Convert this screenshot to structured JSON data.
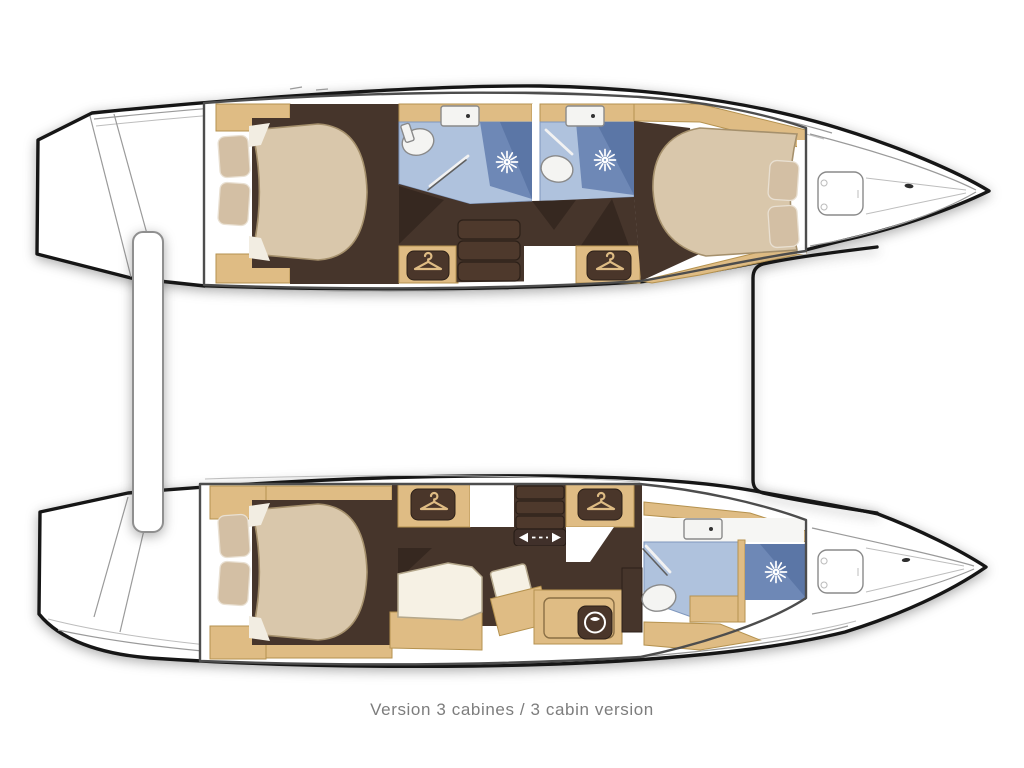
{
  "caption": {
    "text": "Version 3 cabines / 3 cabin version"
  },
  "palette": {
    "outline": "#161616",
    "deckline": "#9a9a9a",
    "boxborder": "#4d4d4d",
    "wood": "#dfbc84",
    "woodStroke": "#b5924f",
    "floor": "#46352b",
    "floorDark": "#362820",
    "mattress": "#d9c7ab",
    "mattressEdge": "#a5906c",
    "pillow": "#d3bfa4",
    "pillowEdge": "#e9e0d2",
    "sheet": "#f2ede2",
    "bathFloor": "#afc2dd",
    "bathEdge": "#7f97bd",
    "shower": "#6e88b6",
    "showerDark": "#5b76a6",
    "plate": "#4a362a",
    "cushion": "#f6f1e4",
    "caption": "#7d7d7d"
  },
  "icons": {
    "hanger": "clothes hanger (wardrobe locker)",
    "shower_star": "shower head starburst",
    "washer": "washing machine",
    "sink": "washbasin",
    "toilet": "toilet",
    "hatch": "deck hatch",
    "sliding_door": "sliding door arrows"
  },
  "plan_features": {
    "port_hull": [
      "double bed cabin aft",
      "two bathrooms with showers amidships",
      "companionway stairs",
      "two hanger lockers",
      "double bed cabin forward"
    ],
    "starboard_hull": [
      "double bed cabin aft",
      "hanger lockers and shelves",
      "settee and chart desk",
      "washing machine",
      "bathroom with shower forward"
    ],
    "cabins_total": "3"
  }
}
